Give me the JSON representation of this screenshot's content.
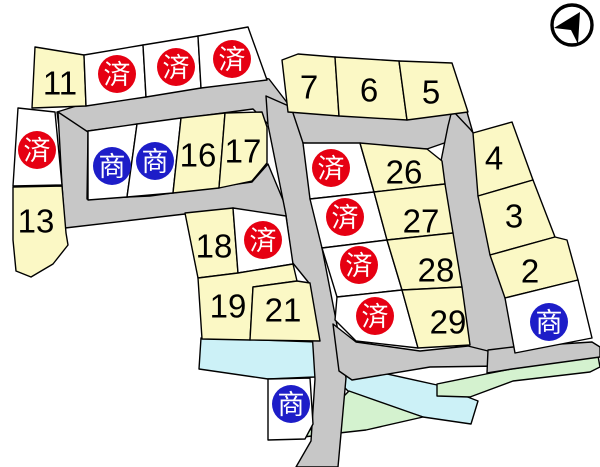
{
  "title": "housing-lot-site-map",
  "colors": {
    "background": "#FFFFFF",
    "lot_yellow": "#FBF8C5",
    "lot_white": "#FFFFFF",
    "road_gray": "#C7C7C7",
    "water_blue": "#CCF1F7",
    "green_space": "#D4F2CF",
    "sold_red": "#E60012",
    "commercial_blue": "#1D1DC8",
    "outline_black": "#000000"
  },
  "badges": {
    "sold_label": "済",
    "commercial_label": "商"
  },
  "compass": {
    "icon": "north-arrow",
    "cx": 572,
    "cy": 25,
    "r": 20
  },
  "map": {
    "roads": [
      {
        "name": "road-top",
        "points": "57,112 86,103 253,75 269,79 292,109 406,117 452,109 467,112 473,133 427,149 303,143 268,124 253,109 88,131 60,134"
      },
      {
        "name": "road-left-l",
        "points": "58,112 88,132 87,199 150,196 252,182 268,164 288,212 286,217 185,214 65,228 62,185"
      },
      {
        "name": "road-diagonal",
        "points": "266,96 291,107 303,143 322,248 336,320 346,378 338,467 296,467 311,441 315,379 309,283 292,262 286,215 268,125"
      },
      {
        "name": "road-right-vertical",
        "points": "452,110 470,129 474,134 516,352 504,363 487,355 468,346 441,161 448,126"
      },
      {
        "name": "road-bottom-branch",
        "points": "333,324 356,342 420,351 468,346 500,354 502,366 430,367 352,380 339,371"
      },
      {
        "name": "road-southeast",
        "points": "488,350 513,347 592,342 600,347 600,357 512,369 487,373"
      }
    ],
    "water": [
      {
        "name": "waterway-west",
        "points": "201,338 318,342 315,377 268,379 199,369"
      },
      {
        "name": "waterway-east",
        "points": "342,364 437,385 478,401 471,424 423,417 350,393 342,385"
      }
    ],
    "green": [
      {
        "name": "green-space-center",
        "points": "349,391 423,417 366,430 303,437"
      },
      {
        "name": "green-space-east",
        "points": "437,384 486,374 511,369 598,356 600,367 590,372 513,381 470,397 437,396"
      }
    ],
    "lots": [
      {
        "name": "lot-11",
        "status": "numbered",
        "label": "11",
        "fill": "lot_yellow",
        "points": "35,47 84,55 86,106 32,108",
        "lx": 60,
        "ly": 83
      },
      {
        "name": "lot-sold-top-1",
        "status": "sold",
        "label": "済",
        "fill": "lot_white",
        "points": "84,55 143,45 146,97 86,106",
        "lx": 117,
        "ly": 74
      },
      {
        "name": "lot-sold-top-2",
        "status": "sold",
        "label": "済",
        "fill": "lot_white",
        "points": "143,45 198,36 201,88 146,97",
        "lx": 176,
        "ly": 67
      },
      {
        "name": "lot-sold-top-3",
        "status": "sold",
        "label": "済",
        "fill": "lot_white",
        "points": "198,36 248,27 267,80 201,88",
        "lx": 232,
        "ly": 59
      },
      {
        "name": "lot-7",
        "status": "numbered",
        "label": "7",
        "fill": "lot_yellow",
        "points": "282,60 298,54 335,57 339,116 288,112",
        "lx": 309,
        "ly": 87
      },
      {
        "name": "lot-6",
        "status": "numbered",
        "label": "6",
        "fill": "lot_yellow",
        "points": "335,57 399,61 407,120 339,116",
        "lx": 369,
        "ly": 90
      },
      {
        "name": "lot-5",
        "status": "numbered",
        "label": "5",
        "fill": "lot_yellow",
        "points": "399,61 452,63 468,112 407,120",
        "lx": 431,
        "ly": 92
      },
      {
        "name": "lot-sold-west",
        "status": "sold",
        "label": "済",
        "fill": "lot_white",
        "points": "18,108 55,112 62,185 13,186",
        "lx": 37,
        "ly": 150
      },
      {
        "name": "lot-13",
        "status": "numbered",
        "label": "13",
        "fill": "lot_yellow",
        "points": "13,187 62,186 66,233 68,245 53,264 31,277 16,271 13,240",
        "lx": 36,
        "ly": 221
      },
      {
        "name": "lot-commercial-1",
        "status": "commercial",
        "label": "商",
        "fill": "lot_white",
        "points": "88,131 137,124 127,197 88,200",
        "lx": 112,
        "ly": 166
      },
      {
        "name": "lot-commercial-2",
        "status": "commercial",
        "label": "商",
        "fill": "lot_white",
        "points": "137,124 181,118 173,193 127,197",
        "lx": 155,
        "ly": 161
      },
      {
        "name": "lot-16",
        "status": "numbered",
        "label": "16",
        "fill": "lot_yellow",
        "points": "181,118 225,113 219,188 173,193",
        "lx": 198,
        "ly": 155
      },
      {
        "name": "lot-17",
        "status": "numbered",
        "label": "17",
        "fill": "lot_yellow",
        "points": "225,113 262,112 267,127 267,163 252,181 219,188",
        "lx": 243,
        "ly": 151
      },
      {
        "name": "lot-18",
        "status": "numbered",
        "label": "18",
        "fill": "lot_yellow",
        "points": "185,213 233,208 238,273 198,278",
        "lx": 214,
        "ly": 246
      },
      {
        "name": "lot-sold-mid",
        "status": "sold",
        "label": "済",
        "fill": "lot_white",
        "points": "233,208 286,216 293,264 238,273",
        "lx": 263,
        "ly": 240
      },
      {
        "name": "lot-19",
        "status": "numbered",
        "label": "19",
        "fill": "lot_yellow",
        "points": "198,278 238,273 293,264 297,281 253,287 250,340 202,339",
        "lx": 228,
        "ly": 306
      },
      {
        "name": "lot-21",
        "status": "numbered",
        "label": "21",
        "fill": "lot_yellow",
        "points": "253,287 297,281 310,283 320,341 250,340",
        "lx": 283,
        "ly": 310
      },
      {
        "name": "lot-sold-col-1",
        "status": "sold",
        "label": "済",
        "fill": "lot_white",
        "points": "303,143 360,143 374,192 310,199",
        "lx": 331,
        "ly": 168
      },
      {
        "name": "lot-sold-col-2",
        "status": "sold",
        "label": "済",
        "fill": "lot_white",
        "points": "310,199 374,192 387,240 322,248",
        "lx": 345,
        "ly": 217
      },
      {
        "name": "lot-sold-col-3",
        "status": "sold",
        "label": "済",
        "fill": "lot_white",
        "points": "322,248 387,240 402,290 337,297",
        "lx": 359,
        "ly": 265
      },
      {
        "name": "lot-sold-col-4",
        "status": "sold",
        "label": "済",
        "fill": "lot_white",
        "points": "337,297 402,290 418,348 356,341 335,320",
        "lx": 375,
        "ly": 316
      },
      {
        "name": "lot-26",
        "status": "numbered",
        "label": "26",
        "fill": "lot_yellow",
        "points": "360,143 427,149 442,161 445,184 374,192",
        "lx": 404,
        "ly": 172
      },
      {
        "name": "lot-27",
        "status": "numbered",
        "label": "27",
        "fill": "lot_yellow",
        "points": "374,192 445,184 453,233 387,240",
        "lx": 421,
        "ly": 221
      },
      {
        "name": "lot-28",
        "status": "numbered",
        "label": "28",
        "fill": "lot_yellow",
        "points": "387,240 453,233 462,287 402,290",
        "lx": 436,
        "ly": 270
      },
      {
        "name": "lot-29",
        "status": "numbered",
        "label": "29",
        "fill": "lot_yellow",
        "points": "402,290 462,287 470,345 418,348",
        "lx": 448,
        "ly": 322
      },
      {
        "name": "lot-4",
        "status": "numbered",
        "label": "4",
        "fill": "lot_yellow",
        "points": "473,133 512,122 533,180 478,196",
        "lx": 494,
        "ly": 158
      },
      {
        "name": "lot-3",
        "status": "numbered",
        "label": "3",
        "fill": "lot_yellow",
        "points": "478,196 533,180 555,237 490,255",
        "lx": 514,
        "ly": 216
      },
      {
        "name": "lot-2",
        "status": "numbered",
        "label": "2",
        "fill": "lot_yellow",
        "points": "490,255 555,237 567,240 578,280 505,298",
        "lx": 530,
        "ly": 271
      },
      {
        "name": "lot-commercial-3",
        "status": "commercial",
        "label": "商",
        "fill": "lot_white",
        "points": "505,298 578,280 592,338 515,353",
        "lx": 549,
        "ly": 322
      },
      {
        "name": "lot-commercial-4",
        "status": "commercial",
        "label": "商",
        "fill": "lot_white",
        "points": "268,379 310,378 313,424 305,439 268,440",
        "lx": 291,
        "ly": 404
      }
    ]
  }
}
